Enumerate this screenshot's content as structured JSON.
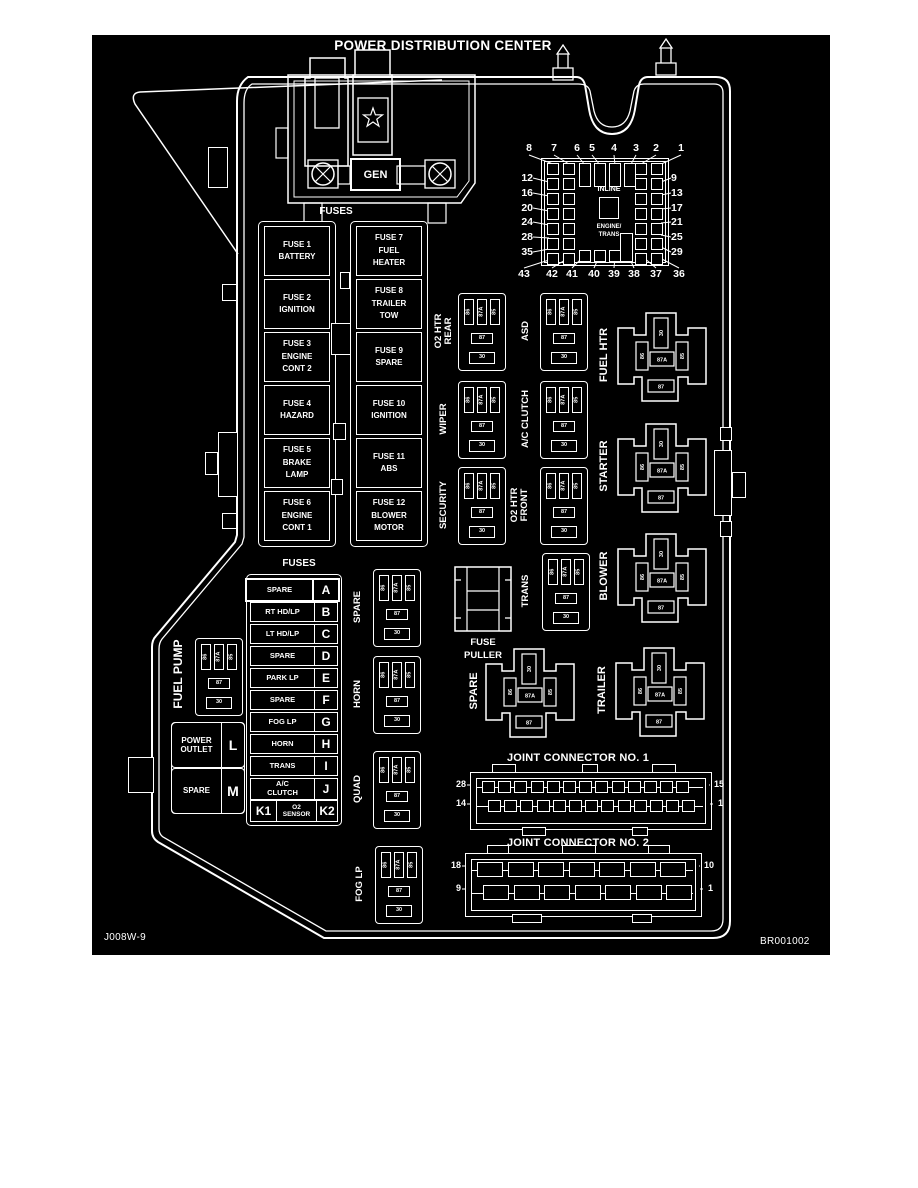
{
  "title": "POWER DISTRIBUTION CENTER",
  "codes": {
    "left": "J008W-9",
    "right": "BR001002"
  },
  "gen": {
    "label": "GEN",
    "fuses_caption": "FUSES"
  },
  "fuse_blocks": {
    "column1": [
      "FUSE 1\nBATTERY",
      "FUSE 2\nIGNITION",
      "FUSE 3\nENGINE\nCONT 2",
      "FUSE 4\nHAZARD",
      "FUSE 5\nBRAKE\nLAMP",
      "FUSE 6\nENGINE\nCONT 1"
    ],
    "column2": [
      "FUSE 7\nFUEL\nHEATER",
      "FUSE 8\nTRAILER\nTOW",
      "FUSE 9\nSPARE",
      "FUSE 10\nIGNITION",
      "FUSE 11\nABS",
      "FUSE 12\nBLOWER\nMOTOR"
    ]
  },
  "cavity_grid": {
    "top": [
      "8",
      "7",
      "6",
      "5",
      "4",
      "3",
      "2",
      "1"
    ],
    "left": [
      "12",
      "16",
      "20",
      "24",
      "28",
      "35"
    ],
    "right": [
      "9",
      "13",
      "17",
      "21",
      "25",
      "29"
    ],
    "bottom": [
      "43",
      "42",
      "41",
      "40",
      "39",
      "38",
      "37",
      "36"
    ],
    "inline": "INLINE",
    "engine_trans": "ENGINE/\nTRANS"
  },
  "mini_relays": [
    {
      "label": "O2 HTR\nREAR"
    },
    {
      "label": "ASD"
    },
    {
      "label": "WIPER"
    },
    {
      "label": "A/C CLUTCH"
    },
    {
      "label": "SECURITY"
    },
    {
      "label": "O2 HTR\nFRONT"
    },
    {
      "label": "TRANS"
    },
    {
      "label": "SPARE"
    },
    {
      "label": "HORN"
    },
    {
      "label": "QUAD"
    },
    {
      "label": "FOG LP"
    },
    {
      "label": "FUEL PUMP"
    }
  ],
  "big_relays": [
    {
      "label": "FUEL HTR"
    },
    {
      "label": "STARTER"
    },
    {
      "label": "BLOWER"
    },
    {
      "label": "TRAILER"
    },
    {
      "label": "SPARE"
    }
  ],
  "relay_pins": {
    "mini_top": [
      "86",
      "87A",
      "85"
    ],
    "mini_mid": "87",
    "mini_bottom": "30",
    "big_top": "30",
    "big_left": "86",
    "big_center": "87A",
    "big_right": "85",
    "big_bottom": "87"
  },
  "fuse_list": {
    "caption": "FUSES",
    "rows": [
      {
        "label": "SPARE",
        "slot": "A"
      },
      {
        "label": "RT HD/LP",
        "slot": "B"
      },
      {
        "label": "LT HD/LP",
        "slot": "C"
      },
      {
        "label": "SPARE",
        "slot": "D"
      },
      {
        "label": "PARK LP",
        "slot": "E"
      },
      {
        "label": "SPARE",
        "slot": "F"
      },
      {
        "label": "FOG LP",
        "slot": "G"
      },
      {
        "label": "HORN",
        "slot": "H"
      },
      {
        "label": "TRANS",
        "slot": "I"
      },
      {
        "label": "A/C\nCLUTCH",
        "slot": "J"
      },
      {
        "left_slot": "K1",
        "label": "O2\nSENSOR",
        "slot": "K2"
      }
    ]
  },
  "outlet_block": [
    {
      "label": "POWER\nOUTLET",
      "slot": "L"
    },
    {
      "label": "SPARE",
      "slot": "M"
    }
  ],
  "fuse_puller": "FUSE\nPULLER",
  "joint_connectors": [
    {
      "title": "JOINT CONNECTOR NO. 1",
      "pins": {
        "top_left": "28",
        "bottom_left": "14",
        "top_right": "15",
        "bottom_right": "1"
      }
    },
    {
      "title": "JOINT CONNECTOR NO. 2",
      "pins": {
        "top_left": "18",
        "bottom_left": "9",
        "top_right": "10",
        "bottom_right": "1"
      }
    }
  ],
  "colors": {
    "page": "#ffffff",
    "background": "#000000",
    "line": "#ffffff"
  }
}
